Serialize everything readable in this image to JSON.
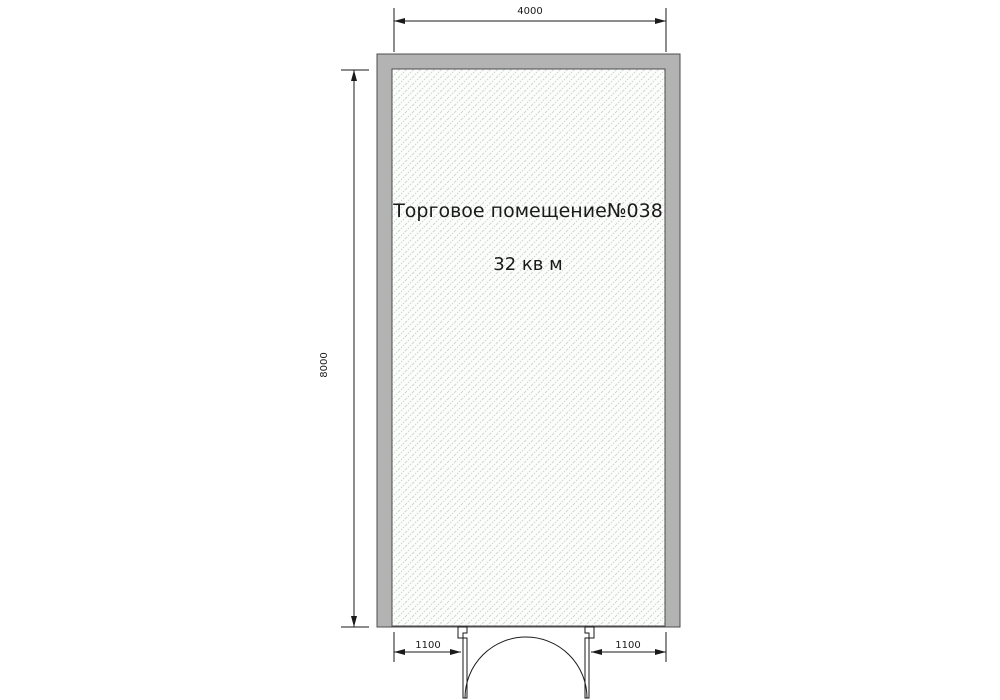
{
  "drawing": {
    "room": {
      "name": "Торговое помещение№038",
      "area": "32 кв м"
    },
    "dimensions": {
      "top_width": "4000",
      "left_height": "8000",
      "door_left_offset": "1100",
      "door_right_offset": "1100"
    },
    "colors": {
      "wall_fill": "#b3b3b3",
      "wall_outline": "#4d4d4d",
      "hatch_line": "#ccd8cc",
      "hatch_background": "#fcfdfc",
      "dimension": "#1a1a1a"
    }
  }
}
